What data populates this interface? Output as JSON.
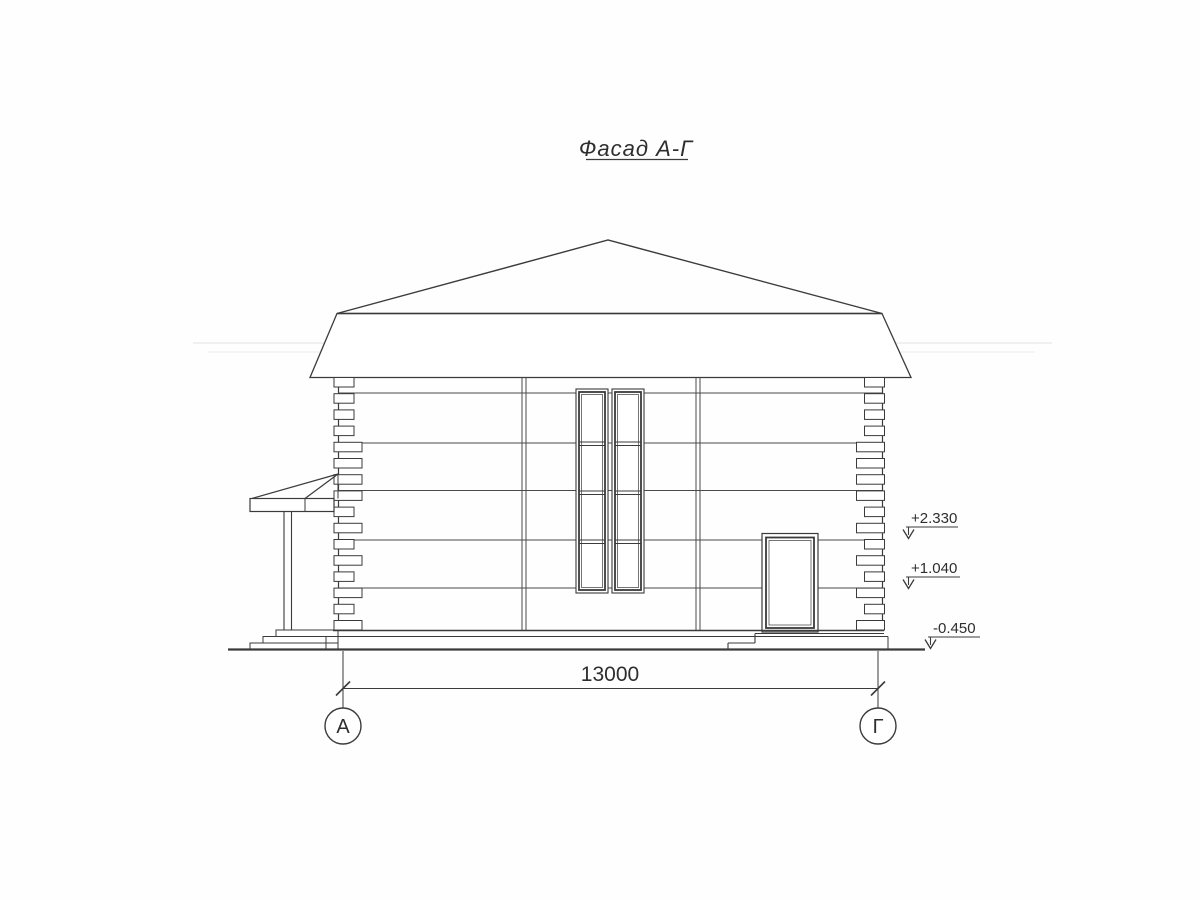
{
  "drawing": {
    "title": "Фасад А-Г",
    "dimension": {
      "value": "13000"
    },
    "axes": {
      "left": "А",
      "right": "Г"
    },
    "elevation_marks": {
      "upper": "+2.330",
      "middle": "+1.040",
      "ground": "-0.450"
    },
    "ink_color": "#3b3b3b",
    "paper_color": "#fefefe"
  }
}
